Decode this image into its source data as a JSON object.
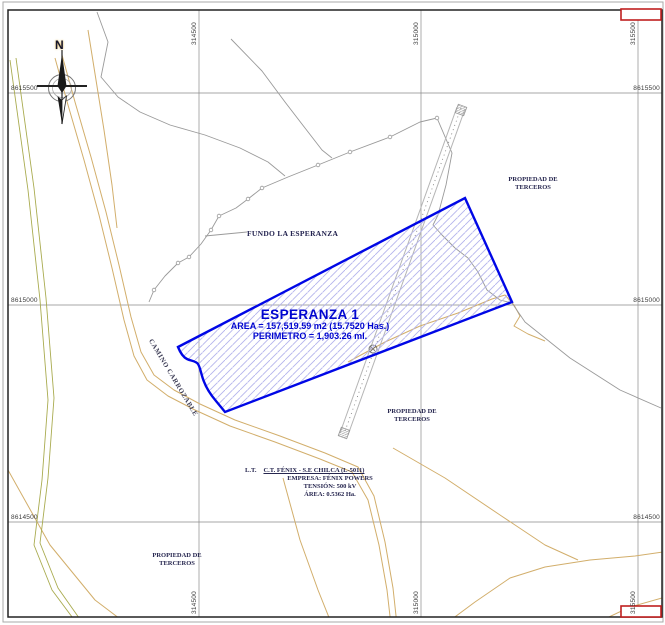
{
  "map": {
    "compass_north": "N",
    "grid": {
      "eastings": [
        "314500",
        "315000",
        "315500"
      ],
      "northings": [
        "8615500",
        "8615000",
        "8614500"
      ]
    },
    "parcel": {
      "name": "ESPERANZA 1",
      "area": "AREA = 157,519.59 m2 (15.7520 Has.)",
      "perimeter": "PERIMETRO = 1,903.26 ml."
    },
    "places": {
      "fundo": "FUNDO LA ESPERANZA",
      "road": "CAMINO CARROZABLE",
      "third_party_line1": "PROPIEDAD DE",
      "third_party_line2": "TERCEROS"
    },
    "transmission_line": {
      "prefix": "L.T.",
      "name": "C.T. FÉNIX - S.E CHILCA (L-5011)",
      "company": "EMPRESA: FÉNIX POWERS",
      "voltage": "TENSIÓN: 500 kV",
      "area": "ÁREA: 0.5362 Ha."
    },
    "colors": {
      "parcel_border": "#0007e6",
      "parcel_hatch": "#b4b4ec",
      "parcel_label": "#0005cf",
      "road": "#d2ae6b",
      "contour": "#9a9a9a",
      "corner_marker": "#bf1f1f"
    }
  }
}
